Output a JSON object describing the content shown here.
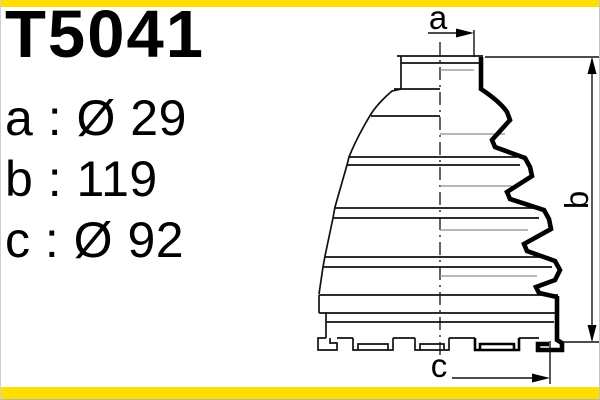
{
  "part_number": "T5041",
  "specs": {
    "rows": [
      {
        "key": "a",
        "separator": " : ",
        "value": "Ø 29",
        "label": "a : Ø 29"
      },
      {
        "key": "b",
        "separator": " : ",
        "value": "119",
        "label": "b : 119"
      },
      {
        "key": "c",
        "separator": " : ",
        "value": "Ø 92",
        "label": "c : Ø 92"
      }
    ]
  },
  "drawing": {
    "description": "CV joint boot (drive-shaft bellow) half-section technical drawing with dimension callouts",
    "dimension_labels": {
      "a": "a",
      "b": "b",
      "c": "c"
    }
  },
  "colors": {
    "accent_bar": "#FFDE00",
    "line": "#000000",
    "background": "#FFFFFF"
  }
}
